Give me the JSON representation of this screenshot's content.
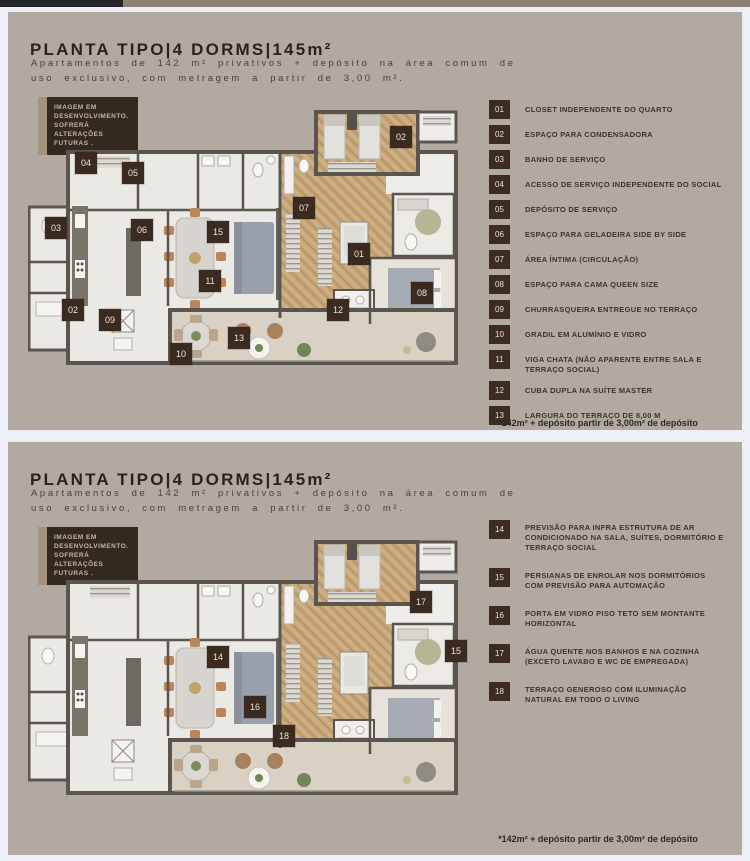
{
  "top_bar": {
    "dark_color": "#26262b",
    "brown_color": "#8b8173"
  },
  "shared": {
    "title": "PLANTA TIPO|4 DORMS|145m²",
    "subtitle_line1": "Apartamentos de 142 m² privativos + depósito na área comum de",
    "subtitle_line2": "uso exclusivo, com metragem a partir de 3,00 m².",
    "badge": "IMAGEM EM DESENVOLVIMENTO. SOFRERÁ ALTERAÇÕES FUTURAS .",
    "footnote": "*142m² + depósito partir de 3,00m² de depósito"
  },
  "colors": {
    "panel_bg": "#b2aaa0",
    "page_gap": "#edeff6",
    "marker_bg": "#3a2a1f",
    "legend_box_bg": "#3c2c21",
    "wall": "#5a564f",
    "wood_floor": "#c8a77b",
    "terrace_floor": "#d8d1c4",
    "light_floor": "#ebe9e4",
    "title_color": "#272420"
  },
  "panels": [
    {
      "markers": [
        {
          "n": "04",
          "x": 58,
          "y": 53
        },
        {
          "n": "05",
          "x": 105,
          "y": 63
        },
        {
          "n": "02",
          "x": 373,
          "y": 27
        },
        {
          "n": "03",
          "x": 28,
          "y": 118
        },
        {
          "n": "06",
          "x": 114,
          "y": 120
        },
        {
          "n": "15",
          "x": 190,
          "y": 122
        },
        {
          "n": "07",
          "x": 276,
          "y": 98
        },
        {
          "n": "01",
          "x": 331,
          "y": 144
        },
        {
          "n": "11",
          "x": 182,
          "y": 171
        },
        {
          "n": "08",
          "x": 394,
          "y": 183
        },
        {
          "n": "02",
          "x": 45,
          "y": 200
        },
        {
          "n": "09",
          "x": 82,
          "y": 210
        },
        {
          "n": "12",
          "x": 310,
          "y": 200
        },
        {
          "n": "13",
          "x": 211,
          "y": 228
        },
        {
          "n": "10",
          "x": 153,
          "y": 244
        }
      ],
      "legend": [
        {
          "num": "01",
          "label": "CLOSET INDEPENDENTE DO QUARTO"
        },
        {
          "num": "02",
          "label": "ESPAÇO PARA CONDENSADORA"
        },
        {
          "num": "03",
          "label": "BANHO DE SERVIÇO"
        },
        {
          "num": "04",
          "label": "ACESSO DE SERVIÇO INDEPENDENTE DO SOCIAL"
        },
        {
          "num": "05",
          "label": "DEPÓSITO DE SERVIÇO"
        },
        {
          "num": "06",
          "label": "ESPAÇO PARA GELADEIRA SIDE BY SIDE"
        },
        {
          "num": "07",
          "label": "ÁREA ÍNTIMA (CIRCULAÇÃO)"
        },
        {
          "num": "08",
          "label": "ESPAÇO PARA CAMA QUEEN SIZE"
        },
        {
          "num": "09",
          "label": "CHURRASQUEIRA ENTREGUE NO TERRAÇO"
        },
        {
          "num": "10",
          "label": "GRADIL EM ALUMÍNIO E VIDRO"
        },
        {
          "num": "11",
          "label": "VIGA CHATA (NÃO APARENTE ENTRE SALA E TERRAÇO SOCIAL)"
        },
        {
          "num": "12",
          "label": "CUBA DUPLA NA SUÍTE MASTER"
        },
        {
          "num": "13",
          "label": "LARGURA DO TERRAÇO DE 8,00 M"
        }
      ]
    },
    {
      "markers": [
        {
          "n": "17",
          "x": 393,
          "y": 62
        },
        {
          "n": "14",
          "x": 190,
          "y": 117
        },
        {
          "n": "15",
          "x": 428,
          "y": 111
        },
        {
          "n": "16",
          "x": 227,
          "y": 167
        },
        {
          "n": "18",
          "x": 256,
          "y": 196
        }
      ],
      "legend": [
        {
          "num": "14",
          "label": "PREVISÃO PARA INFRA ESTRUTURA DE AR CONDICIONADO NA SALA, SUÍTES, DORMITÓRIO E TERRAÇO SOCIAL"
        },
        {
          "num": "15",
          "label": "PERSIANAS DE ENROLAR NOS DORMITÓRIOS COM PREVISÃO PARA AUTOMAÇÃO"
        },
        {
          "num": "16",
          "label": "PORTA EM VIDRO PISO TETO SEM MONTANTE HORIZONTAL"
        },
        {
          "num": "17",
          "label": "ÁGUA QUENTE NOS BANHOS E NA COZINHA  (EXCETO LAVABO E WC DE EMPREGADA)"
        },
        {
          "num": "18",
          "label": "TERRAÇO GENEROSO COM ILUMINAÇÃO NATURAL EM TODO O LIVING"
        }
      ]
    }
  ]
}
